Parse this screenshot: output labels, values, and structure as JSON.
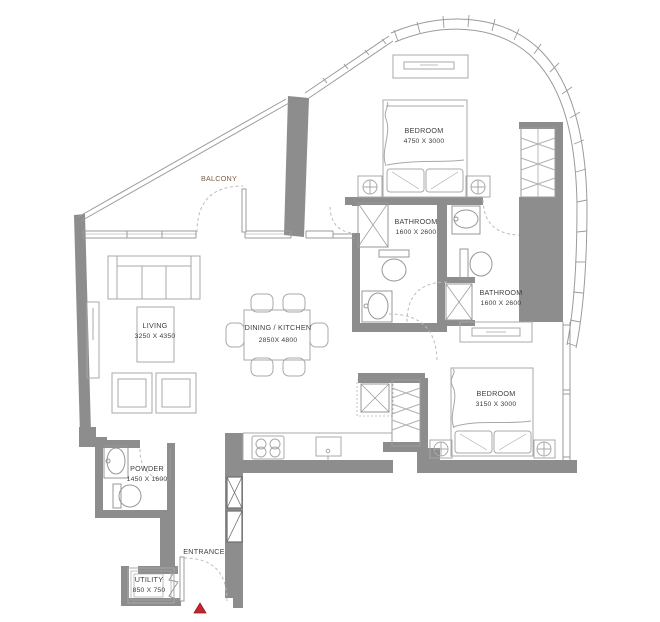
{
  "rooms": {
    "balcony": {
      "name": "BALCONY"
    },
    "bedroom_top": {
      "name": "BEDROOM",
      "dims": "4750 X 3000"
    },
    "bathroom_top": {
      "name": "BATHROOM",
      "dims": "1600 X 2600"
    },
    "bathroom_right": {
      "name": "BATHROOM",
      "dims": "1600 X 2600"
    },
    "living": {
      "name": "LIVING",
      "dims": "3250 X 4350"
    },
    "dining_kitchen": {
      "name": "DINING / KITCHEN",
      "dims": "2850X 4800"
    },
    "bedroom_right": {
      "name": "BEDROOM",
      "dims": "3150 X 3000"
    },
    "powder": {
      "name": "POWDER",
      "dims": "1450 X 1600"
    },
    "entrance": {
      "name": "ENTRANCE"
    },
    "utility": {
      "name": "UTILITY",
      "dims": "850 X 750"
    }
  },
  "colors": {
    "wall": "#8d8d8d",
    "furniture_line": "#a8a8a8",
    "fixture_line": "#979797",
    "door_arc": "#bcbcbc",
    "label_text": "#3e3e3e",
    "balcony_label": "#7c5c44",
    "entrance_marker": "#c1272d"
  }
}
